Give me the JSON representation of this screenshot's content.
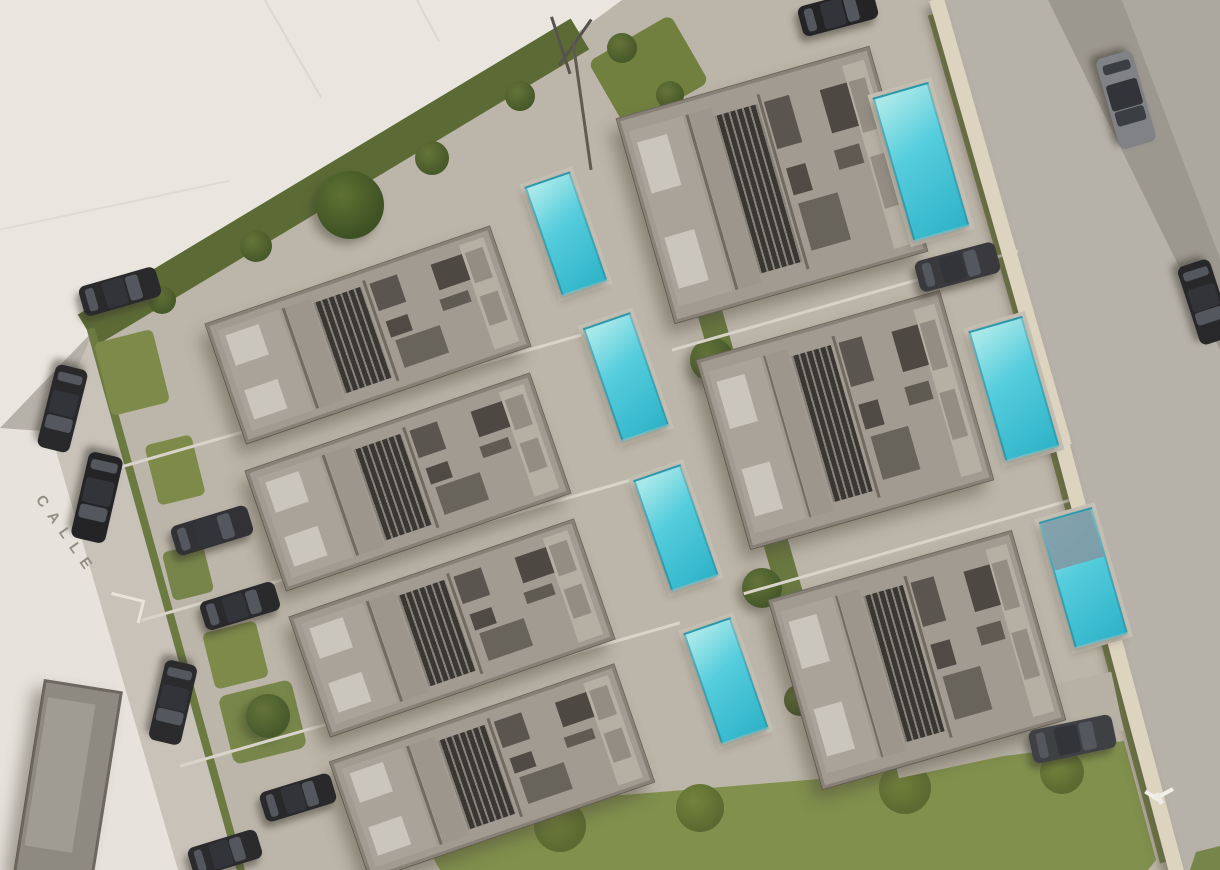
{
  "scene": {
    "canvas": {
      "w": 1220,
      "h": 870,
      "bg": "#b6b1a9"
    },
    "street_label": {
      "text": "CALLE",
      "x": 46,
      "y": 492,
      "rot": 55
    },
    "palette": {
      "pool_light": "#a8e8e9",
      "pool_mid": "#55cddd",
      "pool_deep": "#2fb3c8",
      "pool_deck": "#c6c0b4",
      "pool_cover": "#8099a4",
      "car_glass": "#54575d",
      "car_roof": "#323439",
      "roof": "#a19b92",
      "hedge": "#5c6b36",
      "lawn": "#81904d",
      "wall": "#ddd4bf",
      "vacant_lot": "#eae6df",
      "street": "#c8c2b9"
    },
    "house_template": {
      "parts": [
        {
          "n": "bedroom-block",
          "x": 2,
          "y": 6,
          "w": 22,
          "h": 88,
          "c": "#aaa399"
        },
        {
          "n": "bed",
          "x": 4,
          "y": 12,
          "w": 12,
          "h": 26,
          "c": "#cbc6bd"
        },
        {
          "n": "bed",
          "x": 4,
          "y": 60,
          "w": 12,
          "h": 26,
          "c": "#cbc6bd"
        },
        {
          "n": "wall-line",
          "x": 25,
          "y": 6,
          "w": 1.2,
          "h": 88,
          "c": "#716a60"
        },
        {
          "n": "corridor",
          "x": 26.5,
          "y": 6,
          "w": 9,
          "h": 88,
          "c": "#9c968c"
        },
        {
          "n": "stair-lattice",
          "x": 36,
          "y": 10,
          "w": 17,
          "h": 80,
          "c": "#3a3733",
          "k": "lat"
        },
        {
          "n": "wall-line",
          "x": 54,
          "y": 6,
          "w": 1.2,
          "h": 88,
          "c": "#716a60"
        },
        {
          "n": "kitchen-block",
          "x": 56,
          "y": 10,
          "w": 10,
          "h": 24,
          "c": "#5a564f"
        },
        {
          "n": "kitchen-island",
          "x": 57,
          "y": 44,
          "w": 8,
          "h": 14,
          "c": "#4f4b44"
        },
        {
          "n": "dining-table",
          "x": 58,
          "y": 62,
          "w": 16,
          "h": 24,
          "c": "#68645c"
        },
        {
          "n": "sofa",
          "x": 78,
          "y": 12,
          "w": 13,
          "h": 22,
          "c": "#4d4942"
        },
        {
          "n": "coffee-table",
          "x": 77,
          "y": 42,
          "w": 10,
          "h": 10,
          "c": "#5f5b53"
        },
        {
          "n": "terrace",
          "x": 89,
          "y": 4,
          "w": 9,
          "h": 92,
          "c": "#b5afa4"
        },
        {
          "n": "sun-lounger",
          "x": 90,
          "y": 12,
          "w": 6.5,
          "h": 26,
          "c": "#938d84"
        },
        {
          "n": "sun-lounger",
          "x": 90,
          "y": 50,
          "w": 6.5,
          "h": 26,
          "c": "#938d84"
        }
      ]
    },
    "elements": [
      {
        "t": "poly",
        "n": "vacant-lot",
        "pts": [
          [
            0,
            0
          ],
          [
            648,
            0
          ],
          [
            584,
            30
          ],
          [
            94,
            330
          ],
          [
            0,
            428
          ]
        ],
        "c": "#eae6df"
      },
      {
        "t": "poly",
        "n": "vacant-strip-left",
        "pts": [
          [
            0,
            428
          ],
          [
            56,
            432
          ],
          [
            182,
            870
          ],
          [
            0,
            870
          ]
        ],
        "c": "#e7e3dc"
      },
      {
        "t": "poly",
        "n": "street-west",
        "pts": [
          [
            94,
            330
          ],
          [
            245,
            870
          ],
          [
            178,
            870
          ],
          [
            50,
            430
          ]
        ],
        "c": "#c8c2b9"
      },
      {
        "t": "poly",
        "n": "street-east-dark-strip",
        "pts": [
          [
            1048,
            0
          ],
          [
            1122,
            0
          ],
          [
            1220,
            258
          ],
          [
            1220,
            350
          ]
        ],
        "c": "#9d988f"
      },
      {
        "t": "poly",
        "n": "street-east-corner",
        "pts": [
          [
            1122,
            0
          ],
          [
            1220,
            0
          ],
          [
            1220,
            258
          ]
        ],
        "c": "#aca79f"
      },
      {
        "t": "poly",
        "n": "site-interior",
        "pts": [
          [
            92,
            333
          ],
          [
            584,
            28
          ],
          [
            622,
            0
          ],
          [
            938,
            0
          ],
          [
            1070,
            455
          ],
          [
            1178,
            870
          ],
          [
            245,
            870
          ]
        ],
        "c": "#bcb5a9"
      },
      {
        "t": "poly",
        "n": "lawn-south",
        "pts": [
          [
            430,
            852
          ],
          [
            560,
            800
          ],
          [
            820,
            779
          ],
          [
            1124,
            741
          ],
          [
            1156,
            860
          ],
          [
            1148,
            870
          ],
          [
            440,
            870
          ]
        ],
        "c": "#81904d"
      },
      {
        "t": "poly",
        "n": "grass-corner-se",
        "pts": [
          [
            1190,
            870
          ],
          [
            1196,
            852
          ],
          [
            1220,
            846
          ],
          [
            1220,
            870
          ]
        ],
        "c": "#76854a"
      },
      {
        "t": "tree",
        "n": "lawn-shrub",
        "x": 560,
        "y": 826,
        "r": 26,
        "c": "#5a6a31",
        "hl": "#74843c"
      },
      {
        "t": "tree",
        "n": "lawn-shrub",
        "x": 700,
        "y": 808,
        "r": 24,
        "c": "#5a6a31",
        "hl": "#74843c"
      },
      {
        "t": "tree",
        "n": "lawn-shrub",
        "x": 905,
        "y": 788,
        "r": 26,
        "c": "#5a6a31",
        "hl": "#74843c"
      },
      {
        "t": "tree",
        "n": "lawn-shrub",
        "x": 1062,
        "y": 772,
        "r": 22,
        "c": "#5a6a31",
        "hl": "#74843c"
      },
      {
        "t": "rect",
        "n": "hedge-north",
        "x": 333,
        "y": 182,
        "w": 575,
        "h": 36,
        "rot": -31,
        "c": "#5c6b36"
      },
      {
        "t": "tree",
        "n": "tree-large",
        "x": 350,
        "y": 205,
        "r": 34,
        "c": "#3e5124",
        "hl": "#5f7233",
        "cls": "sh-tree"
      },
      {
        "t": "tree",
        "n": "shrub",
        "x": 432,
        "y": 158,
        "r": 17,
        "c": "#48592a",
        "hl": "#647539"
      },
      {
        "t": "tree",
        "n": "shrub",
        "x": 256,
        "y": 246,
        "r": 16,
        "c": "#48592a",
        "hl": "#647539"
      },
      {
        "t": "tree",
        "n": "shrub",
        "x": 520,
        "y": 96,
        "r": 15,
        "c": "#48592a",
        "hl": "#647539"
      },
      {
        "t": "tree",
        "n": "shrub",
        "x": 162,
        "y": 300,
        "r": 14,
        "c": "#48592a",
        "hl": "#647539"
      },
      {
        "t": "rect",
        "n": "hedge-west",
        "x": 166,
        "y": 600,
        "w": 8,
        "h": 565,
        "rot": -15.5,
        "c": "#6b7a41"
      },
      {
        "t": "rect",
        "n": "hedge-center",
        "x": 745,
        "y": 437,
        "w": 25,
        "h": 676,
        "rot": -16,
        "c": "#697840"
      },
      {
        "t": "tree",
        "n": "tree",
        "x": 712,
        "y": 360,
        "r": 22,
        "c": "#46592a",
        "hl": "#64743a",
        "cls": "sh-tree"
      },
      {
        "t": "tree",
        "n": "tree",
        "x": 762,
        "y": 588,
        "r": 20,
        "c": "#46592a",
        "hl": "#64743a",
        "cls": "sh-tree"
      },
      {
        "t": "tree",
        "n": "shrub",
        "x": 688,
        "y": 232,
        "r": 15,
        "c": "#48592a",
        "hl": "#647539"
      },
      {
        "t": "tree",
        "n": "shrub",
        "x": 800,
        "y": 700,
        "r": 16,
        "c": "#48592a",
        "hl": "#647539"
      },
      {
        "t": "rect",
        "n": "grass-patch",
        "x": 132,
        "y": 372,
        "w": 60,
        "h": 75,
        "rot": -14,
        "c": "#7d8a4a",
        "br": 6
      },
      {
        "t": "rect",
        "n": "grass-patch",
        "x": 175,
        "y": 470,
        "w": 48,
        "h": 62,
        "rot": -14,
        "c": "#7d8a4a",
        "br": 6
      },
      {
        "t": "rect",
        "n": "grass-patch",
        "x": 188,
        "y": 572,
        "w": 42,
        "h": 50,
        "rot": -14,
        "c": "#77854a",
        "br": 6
      },
      {
        "t": "rect",
        "n": "grass-patch",
        "x": 235,
        "y": 655,
        "w": 55,
        "h": 58,
        "rot": -14,
        "c": "#7d8a4a",
        "br": 6
      },
      {
        "t": "rect",
        "n": "grass-patch",
        "x": 262,
        "y": 722,
        "w": 75,
        "h": 70,
        "rot": -14,
        "c": "#78864a",
        "br": 8
      },
      {
        "t": "tree",
        "n": "tree",
        "x": 268,
        "y": 716,
        "r": 22,
        "c": "#46592a",
        "hl": "#64743a",
        "cls": "sh-tree"
      },
      {
        "t": "rect",
        "n": "grass-patch-entrance",
        "x": 648,
        "y": 72,
        "w": 95,
        "h": 78,
        "rot": -30,
        "c": "#71803f",
        "br": 8
      },
      {
        "t": "tree",
        "n": "shrub",
        "x": 622,
        "y": 48,
        "r": 15,
        "c": "#48592a",
        "hl": "#647539"
      },
      {
        "t": "tree",
        "n": "shrub",
        "x": 670,
        "y": 95,
        "r": 14,
        "c": "#48592a",
        "hl": "#647539"
      },
      {
        "t": "rect",
        "n": "grass-strip-wall",
        "x": 992,
        "y": 228,
        "w": 7,
        "h": 445,
        "rot": -16,
        "c": "#6d7c42"
      },
      {
        "t": "rect",
        "n": "grass-strip-wall",
        "x": 1106,
        "y": 650,
        "w": 7,
        "h": 440,
        "rot": -15,
        "c": "#6d7c42"
      },
      {
        "t": "rect",
        "n": "path-line",
        "x": 352,
        "y": 400,
        "w": 515,
        "h": 3,
        "rot": -16,
        "c": "#d9d4ca"
      },
      {
        "t": "rect",
        "n": "path-line",
        "x": 392,
        "y": 548,
        "w": 520,
        "h": 3,
        "rot": -16,
        "c": "#d9d4ca"
      },
      {
        "t": "rect",
        "n": "path-line",
        "x": 430,
        "y": 694,
        "w": 520,
        "h": 3,
        "rot": -16,
        "c": "#d9d4ca"
      },
      {
        "t": "rect",
        "n": "path-line",
        "x": 845,
        "y": 300,
        "w": 360,
        "h": 3,
        "rot": -16,
        "c": "#d9d4ca"
      },
      {
        "t": "rect",
        "n": "path-line",
        "x": 912,
        "y": 545,
        "w": 350,
        "h": 3,
        "rot": -16,
        "c": "#d9d4ca"
      },
      {
        "t": "rect",
        "n": "lot-line",
        "x": 292,
        "y": 48,
        "w": 115,
        "h": 2,
        "rot": 60,
        "c": "#dcd8d0"
      },
      {
        "t": "rect",
        "n": "lot-line",
        "x": 425,
        "y": 15,
        "w": 60,
        "h": 2,
        "rot": 62,
        "c": "#dcd8d0"
      },
      {
        "t": "rect",
        "n": "lot-line",
        "x": 115,
        "y": 205,
        "w": 235,
        "h": 2,
        "rot": -12,
        "c": "#dfdbd3"
      },
      {
        "t": "rect",
        "n": "boundary-wall-east",
        "x": 1000,
        "y": 222,
        "w": 15,
        "h": 465,
        "rot": -16,
        "c": "#ddd4bf",
        "cls": "sh-wall"
      },
      {
        "t": "rect",
        "n": "boundary-wall-east",
        "x": 1118,
        "y": 655,
        "w": 15,
        "h": 450,
        "rot": -15,
        "c": "#ddd4bf",
        "cls": "sh-wall"
      },
      {
        "t": "rect",
        "n": "neighbor-roof",
        "x": 68,
        "y": 782,
        "w": 78,
        "h": 195,
        "rot": 9,
        "c": "#8e8981",
        "bd": "2px solid #6b665f",
        "cls": "sh-house"
      },
      {
        "t": "rect",
        "n": "neighbor-roof-upper",
        "x": 60,
        "y": 775,
        "w": 48,
        "h": 150,
        "rot": 9,
        "c": "#a09b93"
      },
      {
        "t": "rect",
        "n": "driveway",
        "x": 1005,
        "y": 725,
        "w": 230,
        "h": 60,
        "rot": -12,
        "c": "#b7b0a4"
      },
      {
        "t": "house",
        "n": "villa-1",
        "x": 368,
        "y": 335,
        "l": 300,
        "w": 126,
        "rot": -19
      },
      {
        "t": "house",
        "n": "villa-2",
        "x": 408,
        "y": 482,
        "l": 300,
        "w": 126,
        "rot": -19
      },
      {
        "t": "house",
        "n": "villa-3",
        "x": 452,
        "y": 628,
        "l": 300,
        "w": 126,
        "rot": -19
      },
      {
        "t": "house",
        "n": "villa-4",
        "x": 492,
        "y": 772,
        "l": 300,
        "w": 124,
        "rot": -19
      },
      {
        "t": "house",
        "n": "villa-5",
        "x": 772,
        "y": 185,
        "l": 262,
        "w": 212,
        "rot": -16
      },
      {
        "t": "house",
        "n": "villa-6",
        "x": 845,
        "y": 420,
        "l": 252,
        "w": 196,
        "rot": -16
      },
      {
        "t": "house",
        "n": "villa-7",
        "x": 917,
        "y": 660,
        "l": 252,
        "w": 196,
        "rot": -16
      },
      {
        "t": "pool",
        "n": "pool-1",
        "x": 566,
        "y": 234,
        "w": 48,
        "h": 116,
        "rot": -19
      },
      {
        "t": "pool",
        "n": "pool-2",
        "x": 626,
        "y": 377,
        "w": 50,
        "h": 120,
        "rot": -19
      },
      {
        "t": "pool",
        "n": "pool-3",
        "x": 676,
        "y": 528,
        "w": 50,
        "h": 118,
        "rot": -19
      },
      {
        "t": "pool",
        "n": "pool-4",
        "x": 726,
        "y": 681,
        "w": 50,
        "h": 118,
        "rot": -19
      },
      {
        "t": "pool",
        "n": "pool-5",
        "x": 921,
        "y": 162,
        "w": 58,
        "h": 150,
        "rot": -16
      },
      {
        "t": "pool",
        "n": "pool-6",
        "x": 1014,
        "y": 389,
        "w": 56,
        "h": 136,
        "rot": -16
      },
      {
        "t": "pool",
        "n": "pool-7",
        "x": 1083,
        "y": 578,
        "w": 55,
        "h": 132,
        "rot": -16,
        "cover": 0.38
      },
      {
        "t": "car",
        "n": "car-street-west",
        "x": 62,
        "y": 408,
        "l": 85,
        "w": 33,
        "rot": 104,
        "c": "#29292c"
      },
      {
        "t": "car",
        "n": "car-street-west",
        "x": 97,
        "y": 497,
        "l": 88,
        "w": 35,
        "rot": 103,
        "c": "#242427"
      },
      {
        "t": "car",
        "n": "car-street-west",
        "x": 173,
        "y": 702,
        "l": 82,
        "w": 33,
        "rot": 103,
        "c": "#2b2a2d"
      },
      {
        "t": "car",
        "n": "car-parked",
        "x": 120,
        "y": 291,
        "l": 80,
        "w": 31,
        "rot": -16,
        "c": "#2a2a2d"
      },
      {
        "t": "car",
        "n": "car-parked",
        "x": 212,
        "y": 530,
        "l": 80,
        "w": 31,
        "rot": -17,
        "c": "#323236"
      },
      {
        "t": "car",
        "n": "car-parked",
        "x": 240,
        "y": 606,
        "l": 78,
        "w": 30,
        "rot": -17,
        "c": "#2a2a2d"
      },
      {
        "t": "car",
        "n": "car-parked",
        "x": 298,
        "y": 797,
        "l": 74,
        "w": 31,
        "rot": -17,
        "c": "#29292c"
      },
      {
        "t": "car",
        "n": "car-parked",
        "x": 225,
        "y": 853,
        "l": 72,
        "w": 30,
        "rot": -17,
        "c": "#2b2b2e"
      },
      {
        "t": "car",
        "n": "car-parked",
        "x": 957,
        "y": 267,
        "l": 83,
        "w": 32,
        "rot": -15,
        "c": "#3a3a3e"
      },
      {
        "t": "car",
        "n": "car-driveway-se",
        "x": 1072,
        "y": 739,
        "l": 85,
        "w": 34,
        "rot": -12,
        "c": "#3f4044"
      },
      {
        "t": "car",
        "n": "car-driving-east",
        "x": 1126,
        "y": 100,
        "l": 94,
        "w": 38,
        "rot": 74,
        "c": "#808285",
        "g": "#3b3e43"
      },
      {
        "t": "car",
        "n": "car-street-east",
        "x": 1205,
        "y": 302,
        "l": 82,
        "w": 34,
        "rot": 72,
        "c": "#28282b"
      },
      {
        "t": "car",
        "n": "car-street-north",
        "x": 838,
        "y": 12,
        "l": 78,
        "w": 31,
        "rot": -15,
        "c": "#242427"
      },
      {
        "t": "rect",
        "n": "pole-strut",
        "x": 561,
        "y": 45,
        "w": 60,
        "h": 2.5,
        "rot": 72,
        "c": "#56534b"
      },
      {
        "t": "rect",
        "n": "pole-strut",
        "x": 575,
        "y": 42,
        "w": 56,
        "h": 2.5,
        "rot": -55,
        "c": "#56534b"
      },
      {
        "t": "rect",
        "n": "utility-pole",
        "x": 582,
        "y": 105,
        "w": 130,
        "h": 3,
        "rot": 82,
        "c": "#5e5b52"
      },
      {
        "t": "rect",
        "n": "road-marking",
        "x": 128,
        "y": 597,
        "w": 34,
        "h": 3,
        "rot": 14,
        "c": "#e8e4da"
      },
      {
        "t": "rect",
        "n": "road-marking",
        "x": 141,
        "y": 611,
        "w": 24,
        "h": 3,
        "rot": 104,
        "c": "#e8e4da"
      },
      {
        "t": "rect",
        "n": "bird-wing",
        "x": 1152,
        "y": 796,
        "w": 17,
        "h": 4,
        "rot": 32,
        "c": "#f3f0ea"
      },
      {
        "t": "rect",
        "n": "bird-wing",
        "x": 1165,
        "y": 793,
        "w": 17,
        "h": 4,
        "rot": -28,
        "c": "#f3f0ea"
      },
      {
        "t": "rect",
        "n": "bird-body",
        "x": 1159,
        "y": 798,
        "w": 12,
        "h": 5,
        "rot": 60,
        "c": "#eeebe4"
      }
    ]
  }
}
